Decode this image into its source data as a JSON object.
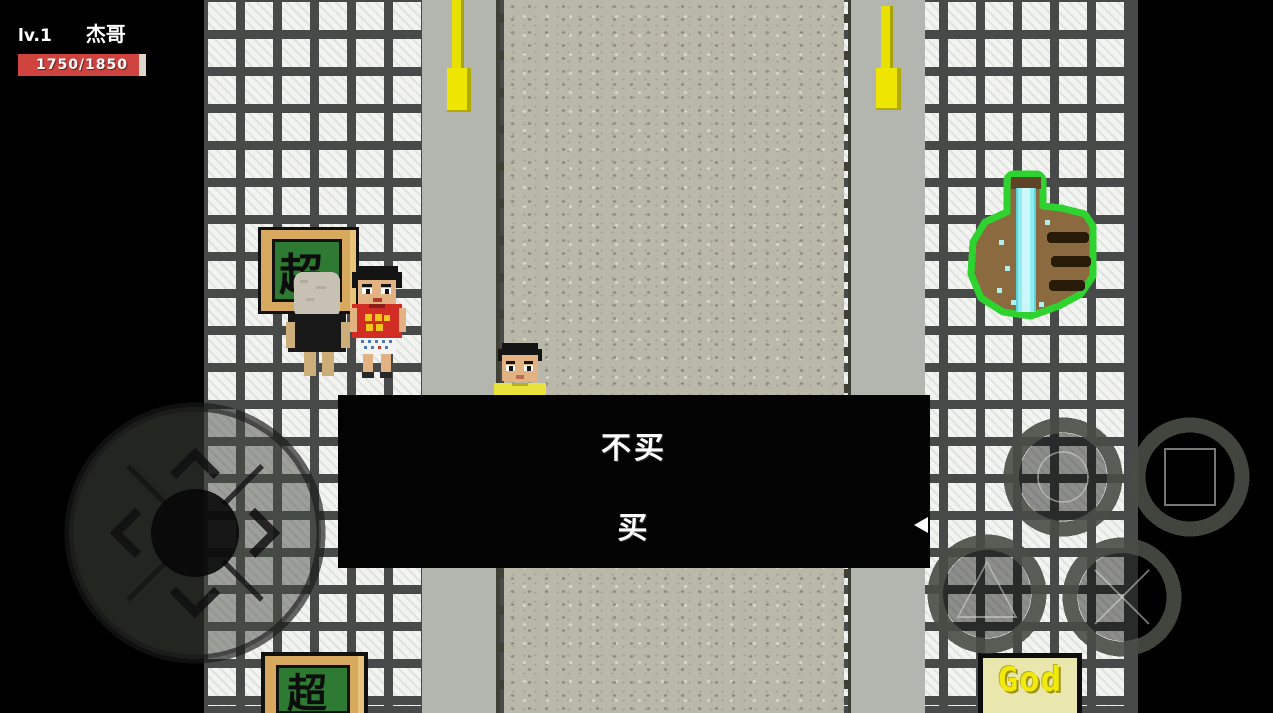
{
  "hud": {
    "level_label": "lv.1",
    "player_name": "杰哥",
    "hp_text": "1750/1850",
    "hp_current": 1750,
    "hp_max": 1850,
    "hp_percent": 94.6,
    "hp_color": "#d04440"
  },
  "dialog": {
    "options": [
      {
        "label": "不买",
        "selected": false
      },
      {
        "label": "买",
        "selected": true
      }
    ],
    "cursor": "left-triangle-icon",
    "cursor_color": "#ffffff",
    "background": "#030303"
  },
  "scene": {
    "shop_sign_top_text": "超",
    "shop_sign_bottom_text": "超",
    "god_sign_text": "God",
    "objects": [
      "chalkboard-sign",
      "shopkeeper-npc",
      "red-shirt-npc",
      "player-character",
      "street-lamp-left",
      "street-lamp-right",
      "thumbs-up-statue",
      "god-sign",
      "chalkboard-sign-bottom"
    ],
    "colors": {
      "tile": "#f3f4f2",
      "grout": "#474a49",
      "road": "#bab7ab",
      "shoulder": "#b2b6ae",
      "lamp_yellow": "#e8e000",
      "sign_frame_tan": "#d6a95e",
      "sign_board_green": "#2f7a33",
      "statue_green": "#2fd32f",
      "statue_brown": "#8a6a3e",
      "stream_cyan": "#8feef2",
      "god_text_yellow": "#f2ea0a"
    }
  },
  "controls": {
    "dpad": {
      "directions": [
        "up",
        "left",
        "right",
        "down"
      ]
    },
    "action_buttons": [
      {
        "glyph": "circle-icon"
      },
      {
        "glyph": "square-icon"
      },
      {
        "glyph": "triangle-icon"
      },
      {
        "glyph": "cross-icon"
      }
    ]
  }
}
